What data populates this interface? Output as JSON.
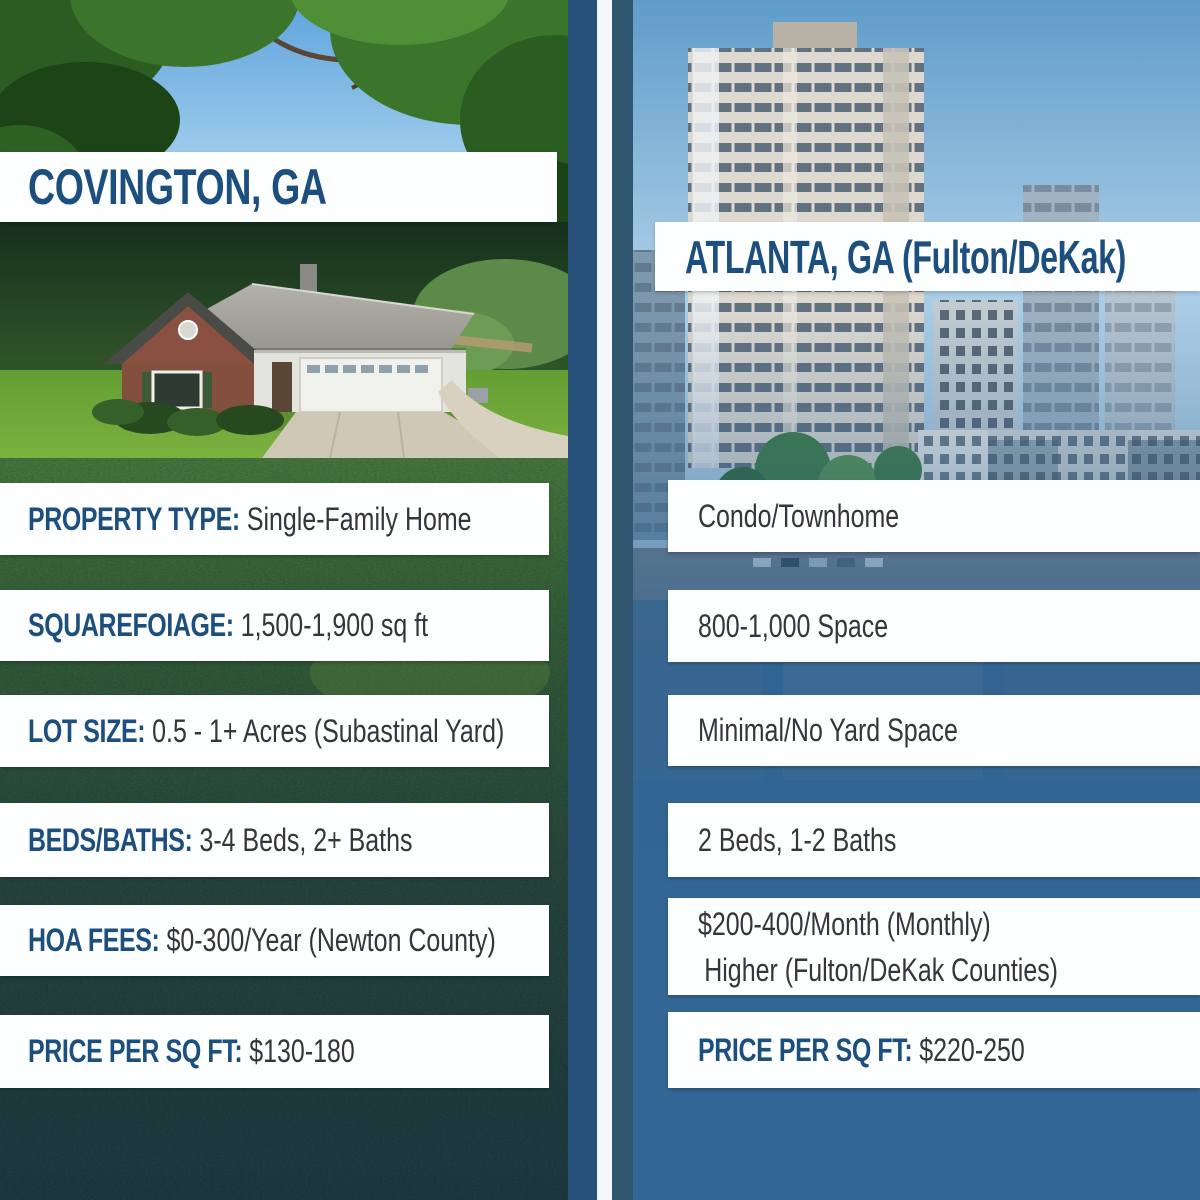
{
  "colors": {
    "panel_blue": "#2e5f8c",
    "solid_blue_right": "#336695",
    "divider_navy": "#27517a",
    "heading_navy": "#1d4f7e",
    "value_gray": "#35353a",
    "bar_white": "#fdfeff"
  },
  "left": {
    "title": "COVINGTON, GA",
    "photo_top": "trees-and-sky-photo",
    "photo_inset": "single-family-home-aerial-photo",
    "photo_background": "grass-lawn-photo",
    "rows": [
      {
        "label": "PROPERTY TYPE:",
        "value": "Single-Family Home"
      },
      {
        "label": "SQUAREFOIAGE:",
        "value": "1,500-1,900 sq ft"
      },
      {
        "label": "LOT SIZE:",
        "value": "0.5 - 1+ Acres (Subastinal Yard)"
      },
      {
        "label": "BEDS/BATHS:",
        "value": "3-4 Beds, 2+ Baths"
      },
      {
        "label": "HOA FEES:",
        "value": "$0-300/Year (Newton County)"
      },
      {
        "label": "PRICE PER SQ FT:",
        "value": "$130-180"
      }
    ]
  },
  "right": {
    "title": "ATLANTA, GA (Fulton/DeKak)",
    "photo": "atlanta-highrise-and-townhomes-photo",
    "rows": [
      {
        "value": "Condo/Townhome"
      },
      {
        "value": "800-1,000 Space"
      },
      {
        "value": "Minimal/No Yard Space"
      },
      {
        "value": "2 Beds, 1-2 Baths"
      },
      {
        "value": "$200-400/Month (Monthly)",
        "value2": "Higher (Fulton/DeKak Counties)"
      },
      {
        "label": "PRICE PER SQ FT:",
        "value": "$220-250"
      }
    ]
  }
}
